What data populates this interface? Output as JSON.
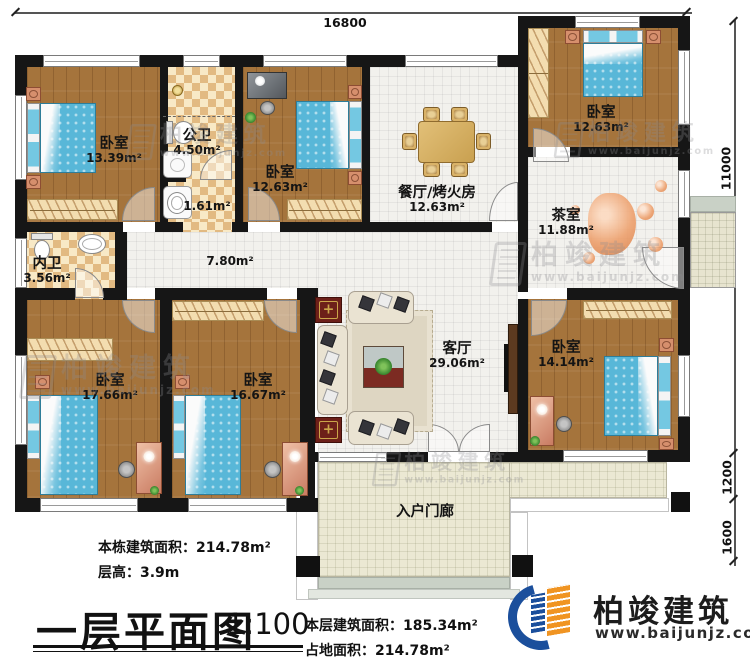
{
  "dims": {
    "top": "16800",
    "side_total": "11000",
    "porch_depth": "1200",
    "porch_front": "1600"
  },
  "rooms": [
    {
      "key": "bedroom-top-left",
      "name": "卧室",
      "area": "13.39m²"
    },
    {
      "key": "public-bath",
      "name": "公卫",
      "area": "4.50m²"
    },
    {
      "key": "vanity",
      "name": "",
      "area": "1.61m²"
    },
    {
      "key": "bedroom-top-mid",
      "name": "卧室",
      "area": "12.63m²"
    },
    {
      "key": "dining-bbq",
      "name": "餐厅/烤火房",
      "area": "12.63m²"
    },
    {
      "key": "bedroom-top-right",
      "name": "卧室",
      "area": "12.63m²"
    },
    {
      "key": "tea-room",
      "name": "茶室",
      "area": "11.88m²"
    },
    {
      "key": "inner-bath",
      "name": "内卫",
      "area": "3.56m²"
    },
    {
      "key": "hallway",
      "name": "",
      "area": "7.80m²"
    },
    {
      "key": "bedroom-bot-left",
      "name": "卧室",
      "area": "17.66m²"
    },
    {
      "key": "bedroom-bot-mid",
      "name": "卧室",
      "area": "16.67m²"
    },
    {
      "key": "living-room",
      "name": "客厅",
      "area": "29.06m²"
    },
    {
      "key": "bedroom-bot-right",
      "name": "卧室",
      "area": "14.14m²"
    },
    {
      "key": "entry-porch",
      "name": "入户门廊",
      "area": ""
    }
  ],
  "info": {
    "building_area": "本栋建筑面积：214.78m²",
    "floor_height": "层高：3.9m",
    "plan_title": "一层平面图",
    "scale": "1:100",
    "floor_area": "本层建筑面积：185.34m²",
    "footprint": "占地面积：214.78m²"
  },
  "brand": {
    "name": "柏竣建筑",
    "site": "www.baijunjz.com"
  },
  "watermark": {
    "name": "柏竣建筑",
    "site": "www.baijunjz.com"
  },
  "colors": {
    "wall": "#161616",
    "wood_floor": "#a5743c",
    "bath_tile": "#e2ba82",
    "bed": "#58b7d8",
    "brand_blue": "#1b4f9c",
    "brand_orange": "#f09422"
  }
}
